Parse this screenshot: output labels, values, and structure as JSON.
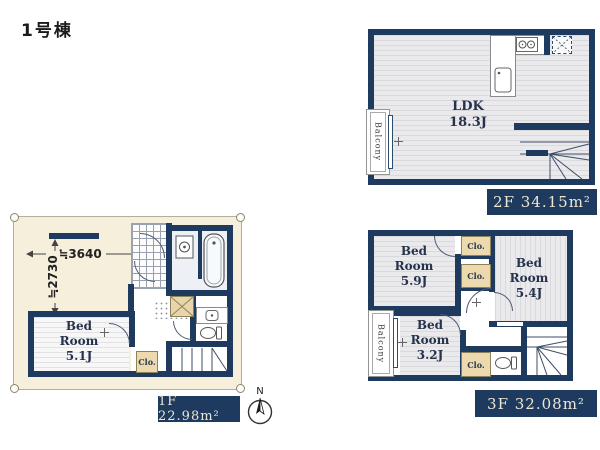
{
  "title": "1号棟",
  "compass": {
    "north_label": "N"
  },
  "floor1": {
    "area_label": "1F 22.98m²",
    "dim_width": "≒3640",
    "dim_height": "≒2730",
    "bedroom_label": "Bed\nRoom\n5.1J",
    "closet_label": "Clo."
  },
  "floor2": {
    "area_label": "2F 34.15m²",
    "ldk_label": "LDK\n18.3J",
    "balcony_label": "Balcony"
  },
  "floor3": {
    "area_label": "3F 32.08m²",
    "bedroom_59_label": "Bed\nRoom\n5.9J",
    "bedroom_54_label": "Bed\nRoom\n5.4J",
    "bedroom_32_label": "Bed\nRoom\n3.2J",
    "closet_label": "Clo.",
    "balcony_label": "Balcony"
  },
  "colors": {
    "wall_navy": "#1e3a5f",
    "lot_cream": "#f6efdb",
    "closet_beige": "#ecd9ae",
    "floor_gray": "#eaeaec",
    "label_text": "#ece6d3"
  }
}
